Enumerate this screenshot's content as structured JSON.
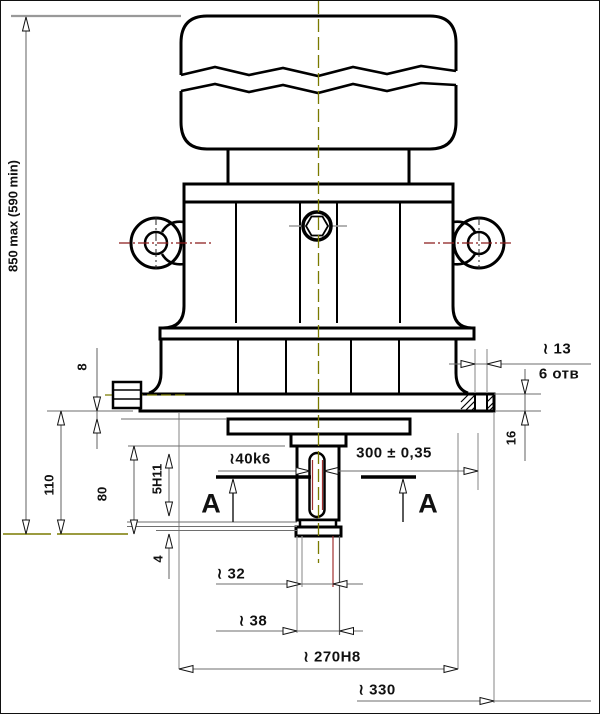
{
  "drawing": {
    "dimensions": {
      "overall_height": "850 max (590 min)",
      "dim_8": "8",
      "dim_110": "110",
      "dim_80": "80",
      "keyway_fit": "5H11",
      "dim_4": "4",
      "shaft_diameter": "≀40k6",
      "shaft_tolerance": "300 ± 0,35",
      "section_label_left": "A",
      "section_label_right": "A",
      "hole_diameter": "≀ 13",
      "hole_count": "6 отв",
      "flange_thickness": "16",
      "dia_32": "≀ 32",
      "dia_38": "≀ 38",
      "spigot_diameter": "≀ 270H8",
      "flange_outer_diameter": "≀ 330"
    },
    "colors": {
      "outline": "#000000",
      "dimension": "#6e6e6e",
      "centerline": "#7a7a00",
      "lug_centerline": "#8b1a1a",
      "extension_gray": "#999999",
      "keyway_inner": "#a03030"
    }
  }
}
